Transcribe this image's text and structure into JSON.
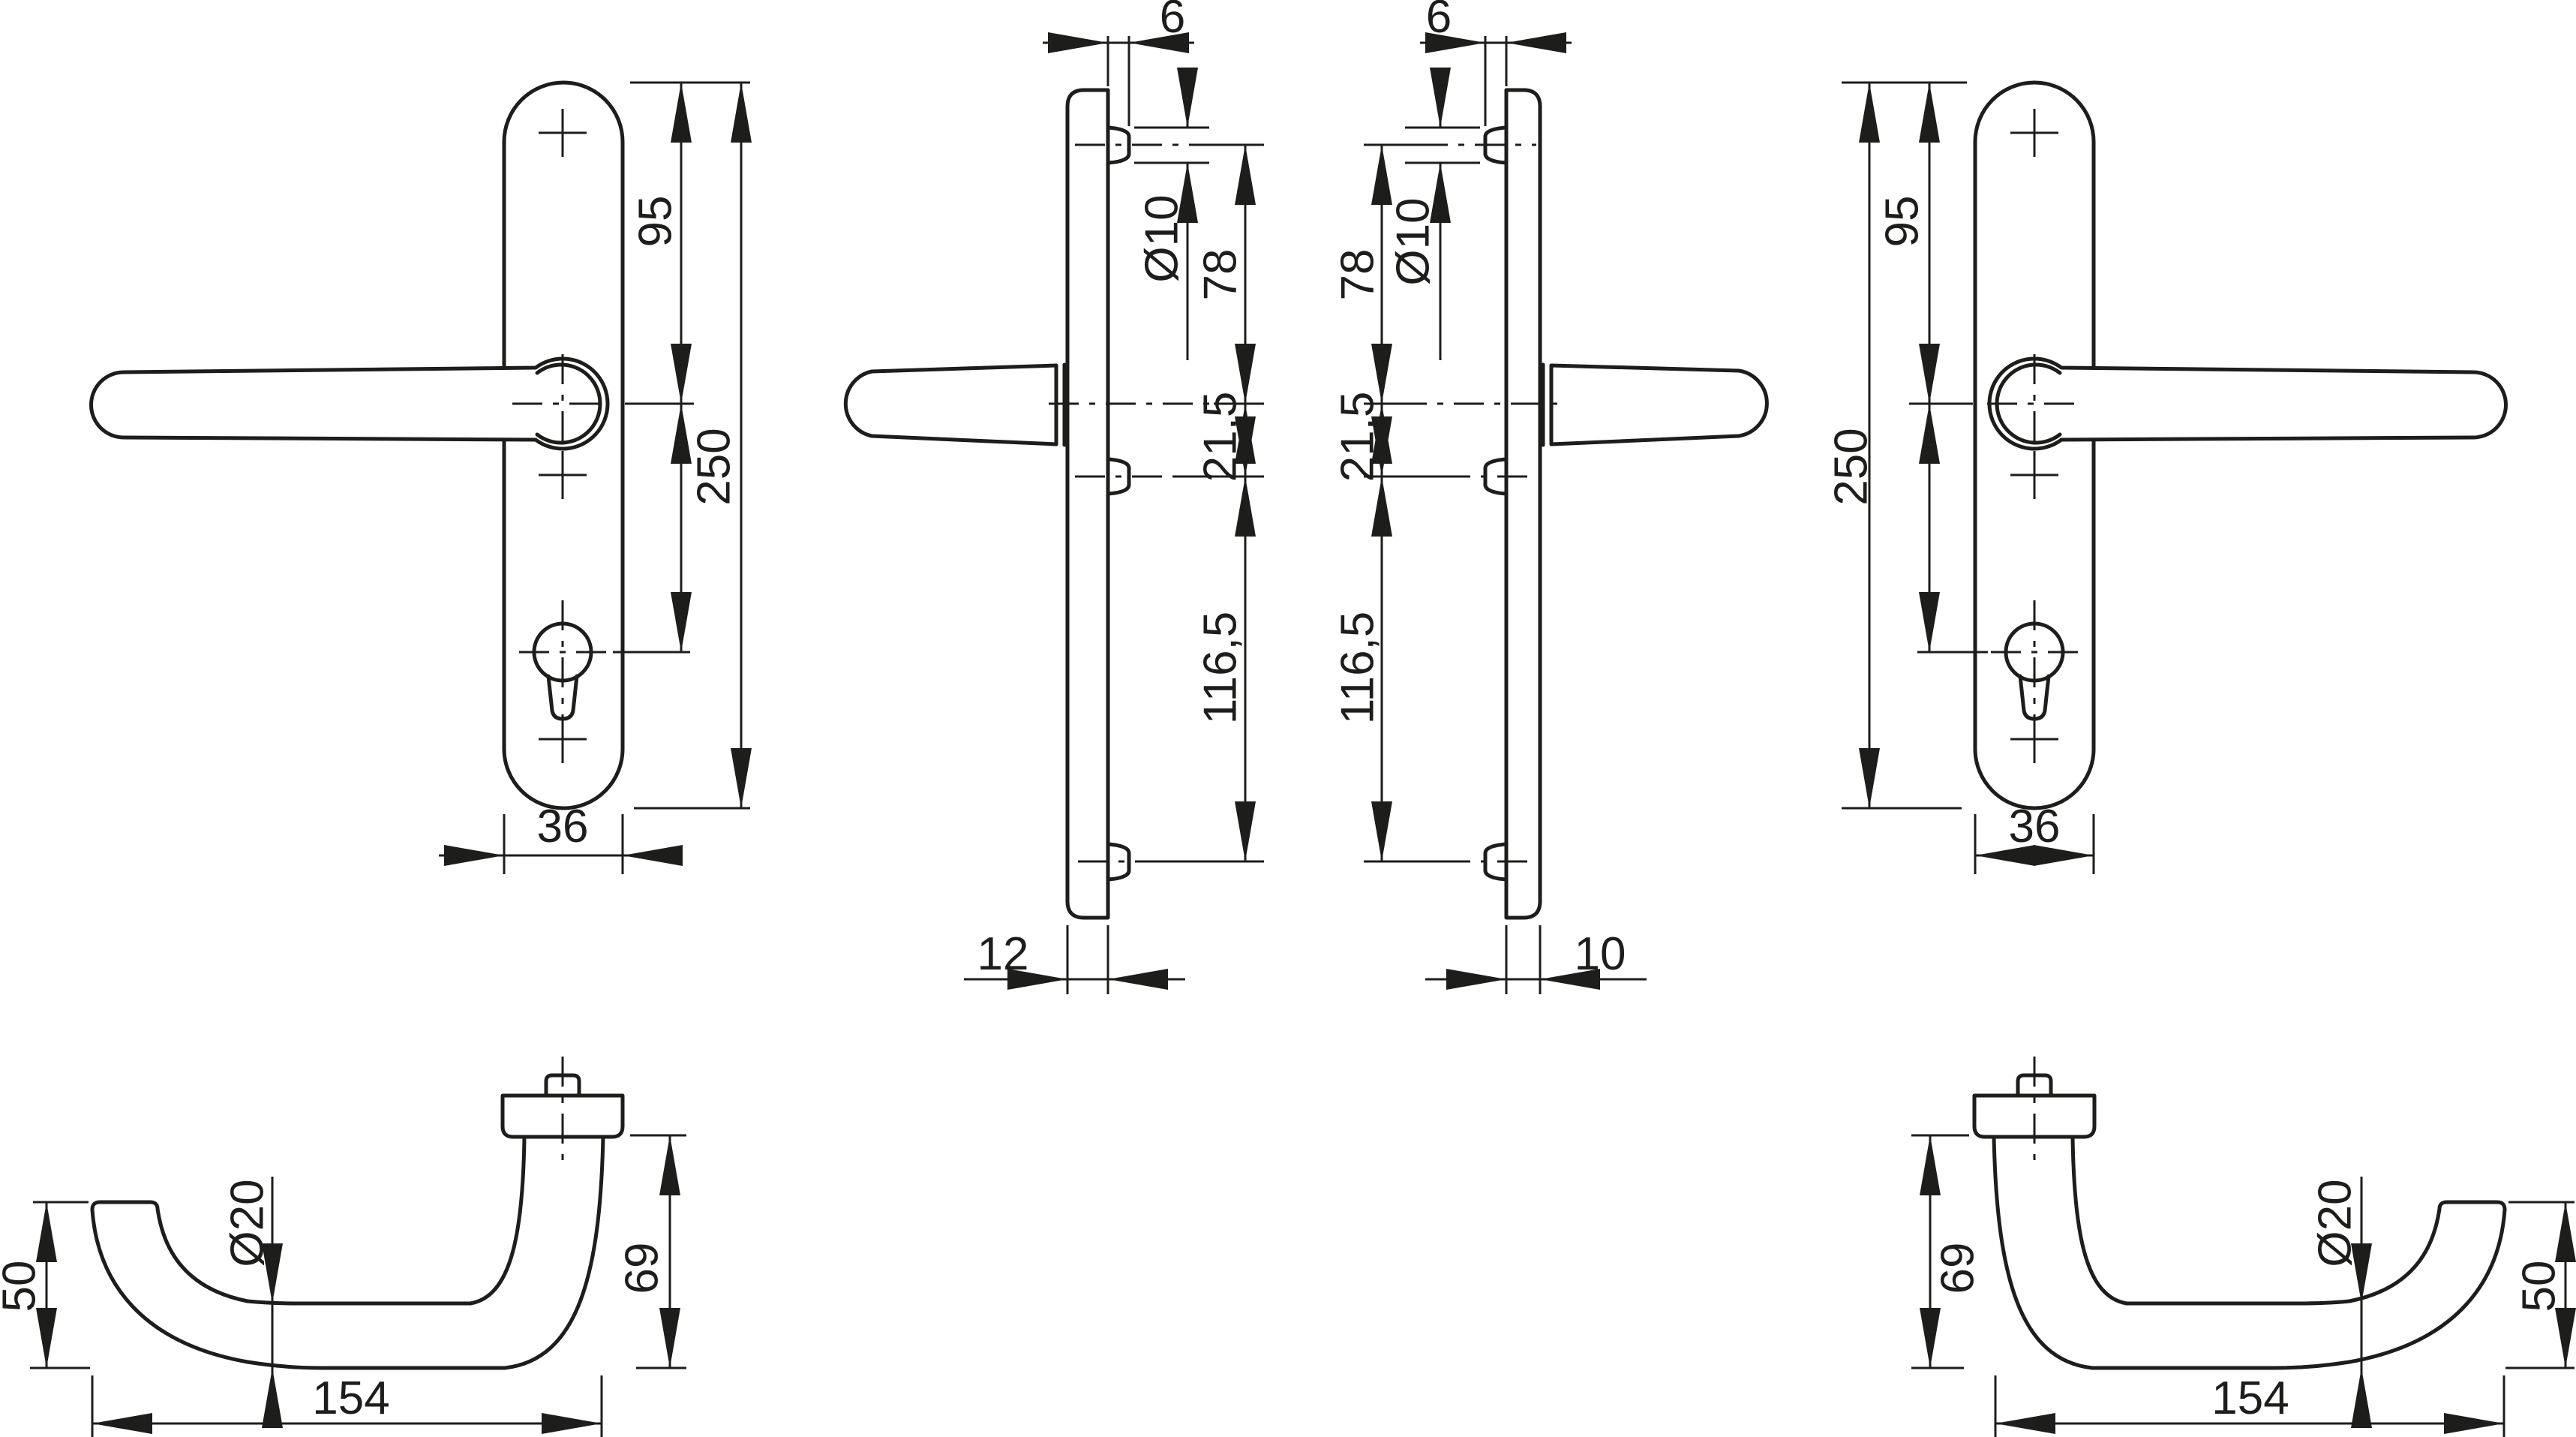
{
  "drawing": {
    "kind": "door-handle-backplate-technical-drawing",
    "units": "mm",
    "colors": {
      "line": "#1d1d1b",
      "background": "#ffffff"
    },
    "views": {
      "front_left": {
        "label": "front-view-left-hand-set",
        "height_to_handle": "95",
        "total_height": "250",
        "plate_width": "36"
      },
      "profile_left": {
        "label": "side-view-left-hand-set",
        "lug_width": "6",
        "hole_diameter": "Ø10",
        "top_to_handle": "78",
        "handle_to_mid": "21,5",
        "mid_to_bottom": "116,5",
        "plate_thickness": "12"
      },
      "profile_right": {
        "label": "side-view-right-hand-set",
        "lug_width": "6",
        "hole_diameter": "Ø10",
        "top_to_handle": "78",
        "handle_to_mid": "21,5",
        "mid_to_bottom": "116,5",
        "plate_thickness": "10"
      },
      "front_right": {
        "label": "front-view-right-hand-set",
        "height_to_handle": "95",
        "total_height": "250",
        "plate_width": "36"
      },
      "lever_left": {
        "label": "top-view-left-lever",
        "end_rise": "50",
        "grip_diameter": "Ø20",
        "projection": "69",
        "length": "154"
      },
      "lever_right": {
        "label": "top-view-right-lever",
        "end_rise": "50",
        "grip_diameter": "Ø20",
        "projection": "69",
        "length": "154"
      }
    }
  }
}
